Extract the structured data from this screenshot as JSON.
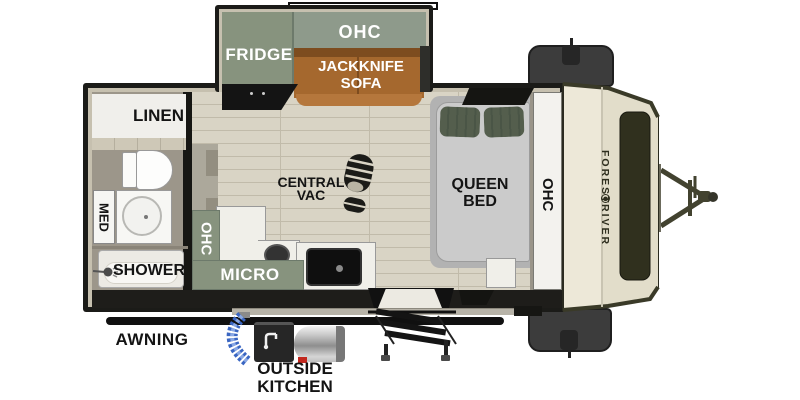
{
  "plan": {
    "type": "travel-trailer floor plan",
    "slideout": {
      "fridge": "FRIDGE",
      "ohc": "OHC",
      "sofa_line1": "JACKKNIFE",
      "sofa_line2": "SOFA"
    },
    "bathroom": {
      "linen": "LINEN",
      "med": "MED",
      "shower": "SHOWER"
    },
    "kitchen": {
      "ohc": "OHC",
      "micro": "MICRO"
    },
    "main": {
      "vac_line1": "CENTRAL",
      "vac_line2": "VAC"
    },
    "bedroom": {
      "bed_line1": "QUEEN",
      "bed_line2": "BED",
      "ohc": "OHC"
    },
    "exterior": {
      "awning": "AWNING",
      "outside_line1": "OUTSIDE",
      "outside_line2": "KITCHEN",
      "brand_word1": "FOREST",
      "brand_word2": "RIVER"
    }
  },
  "colors": {
    "wall_black": "#1b1b18",
    "wall_tan": "#c6c0af",
    "floor_wood": "#d9d4c5",
    "floor_line": "#c1bbaa",
    "floor_bath": "#9c968a",
    "cabinet_green": "#87937e",
    "cabinet_green2": "#8e9a8b",
    "sofa_brown": "#a5682e",
    "sofa_brown_dark": "#7d4c1f",
    "sofa_brown_light": "#b5773c",
    "counter_white": "#f0efe9",
    "mattress_gray": "#cbcbcb",
    "bed_base": "#b2b2b2",
    "pillow_green": "#545e4d",
    "cap_cream": "#ede8d8",
    "cap_shade": "#e2ddca",
    "olive": "#3a3a28",
    "panel_dark": "#30301e",
    "box_gray": "#3c3c3c",
    "hose_blue": "#3a66c2",
    "hose_blue_light": "#89a8e4",
    "tank_red": "#c2281e"
  }
}
